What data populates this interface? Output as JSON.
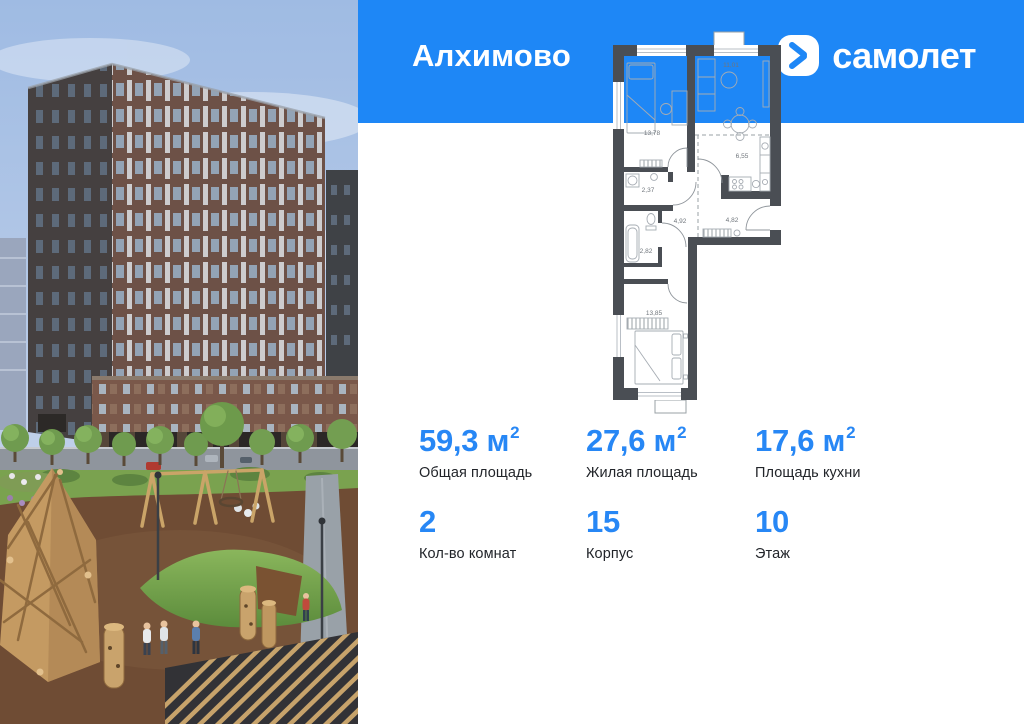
{
  "header": {
    "project_name": "Алхимово",
    "brand": "самолет"
  },
  "logo": {
    "mark": "chevron-right-icon"
  },
  "plan": {
    "rooms": [
      {
        "name": "bedroom-1",
        "area": "13,78"
      },
      {
        "name": "living-room",
        "area": "11,01"
      },
      {
        "name": "kitchen",
        "area": "6,55"
      },
      {
        "name": "toilet",
        "area": "2,37"
      },
      {
        "name": "hall",
        "area": "4,92"
      },
      {
        "name": "corridor",
        "area": "4,82"
      },
      {
        "name": "bathroom",
        "area": "2,82"
      },
      {
        "name": "bedroom-2",
        "area": "13,85"
      }
    ]
  },
  "stats": {
    "row1": [
      {
        "value": "59,3",
        "unit": "м",
        "sup": "2",
        "label": "Общая площадь"
      },
      {
        "value": "27,6",
        "unit": "м",
        "sup": "2",
        "label": "Жилая площадь"
      },
      {
        "value": "17,6",
        "unit": "м",
        "sup": "2",
        "label": "Площадь кухни"
      }
    ],
    "row2": [
      {
        "value": "2",
        "label": "Кол-во комнат"
      },
      {
        "value": "15",
        "label": "Корпус"
      },
      {
        "value": "10",
        "label": "Этаж"
      }
    ]
  },
  "colors": {
    "header_blue": "#1e87f6",
    "accent_blue": "#2787f5",
    "plan_wall": "#4a4e54"
  }
}
